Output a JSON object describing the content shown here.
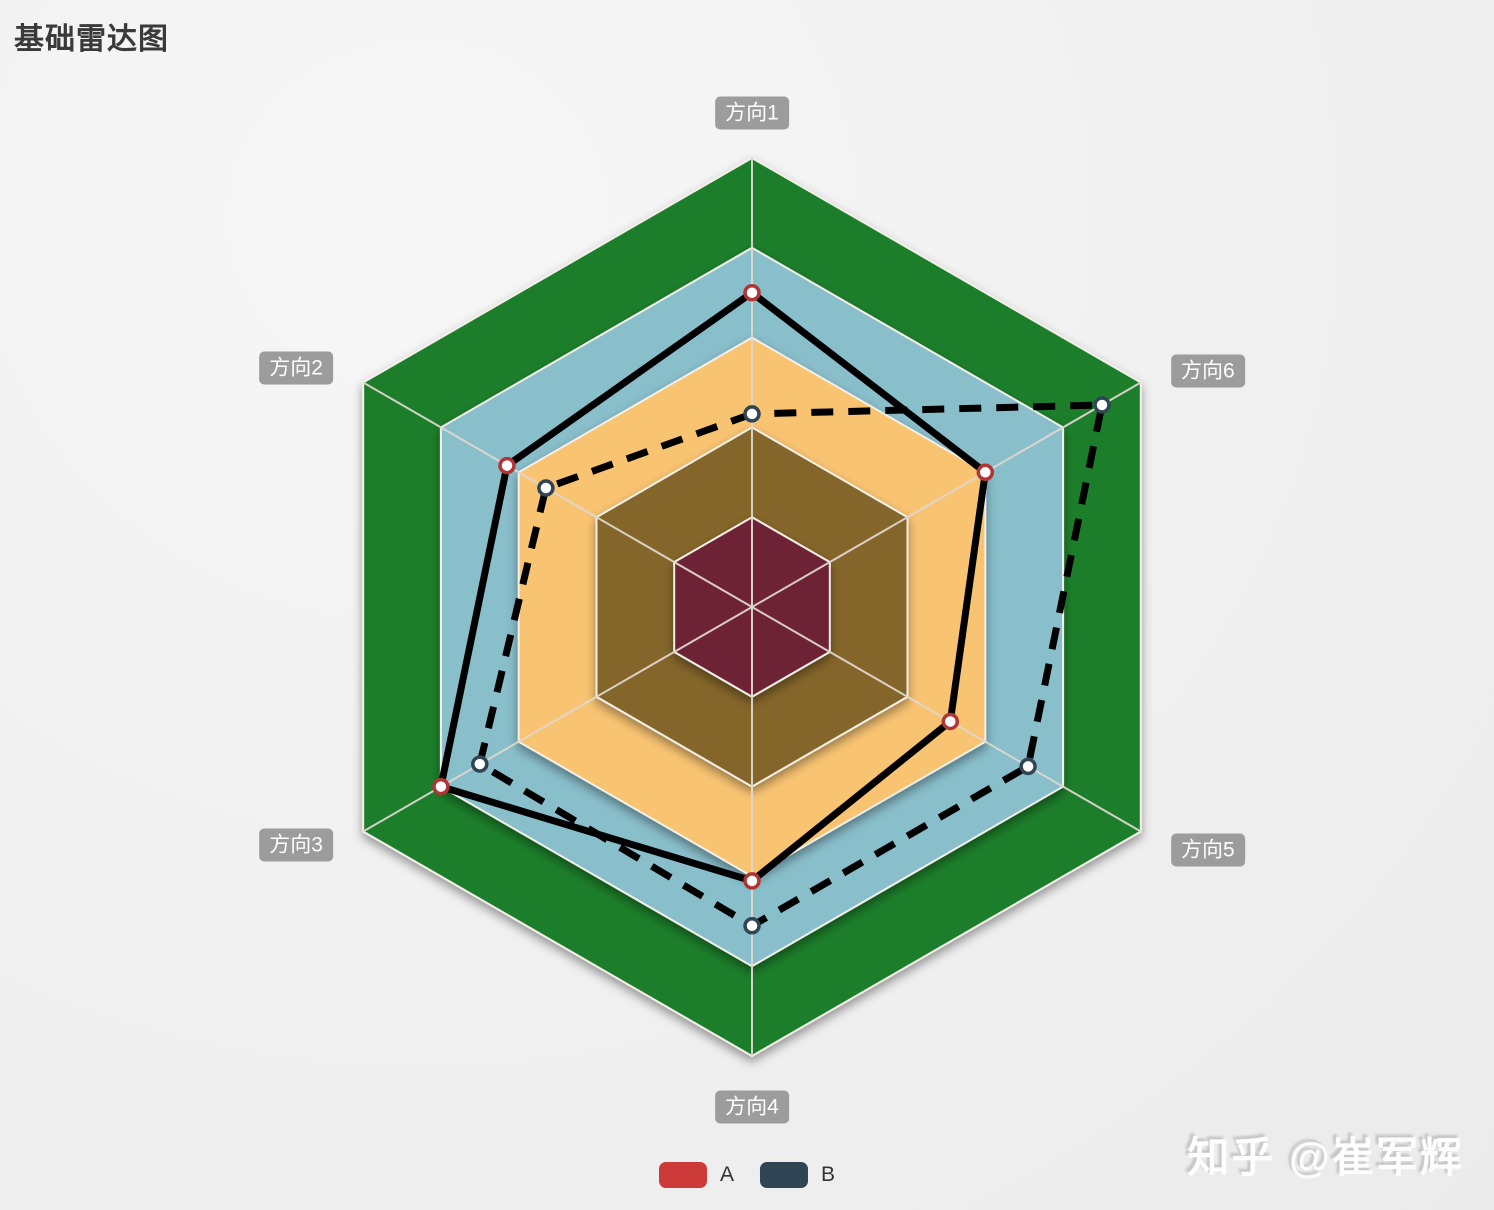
{
  "page": {
    "title": "基础雷达图",
    "watermark": "知乎 @崔军辉"
  },
  "chart_data": {
    "type": "radar",
    "title": "基础雷达图",
    "indicators": [
      {
        "name": "方向1",
        "max": 100
      },
      {
        "name": "方向2",
        "max": 100
      },
      {
        "name": "方向3",
        "max": 100
      },
      {
        "name": "方向4",
        "max": 100
      },
      {
        "name": "方向5",
        "max": 100
      },
      {
        "name": "方向6",
        "max": 100
      }
    ],
    "levels": [
      100,
      80,
      60,
      40,
      20
    ],
    "series": [
      {
        "name": "A",
        "values": [
          70,
          63,
          80,
          61,
          51,
          60
        ],
        "line_style": "solid",
        "line_color": "#000000",
        "symbol_border": "#b03535",
        "legend_color": "#cb3a38"
      },
      {
        "name": "B",
        "values": [
          43,
          53,
          70,
          71,
          71,
          90
        ],
        "line_style": "dashed",
        "line_color": "#000000",
        "symbol_border": "#2f4554",
        "legend_color": "#2f4554"
      }
    ],
    "style": {
      "ring_colors_outer_to_inner": [
        "#1f7e2c",
        "#89becb",
        "#f9c472",
        "#85662a",
        "#6e2135"
      ],
      "axis_line_color": "#ded7cf",
      "split_line_color": "#f3efe9",
      "symbol_fill": "#ffffff",
      "label_bg": "#9c9c9c",
      "label_text_color": "#ffffff",
      "legend_position": "bottom"
    }
  }
}
